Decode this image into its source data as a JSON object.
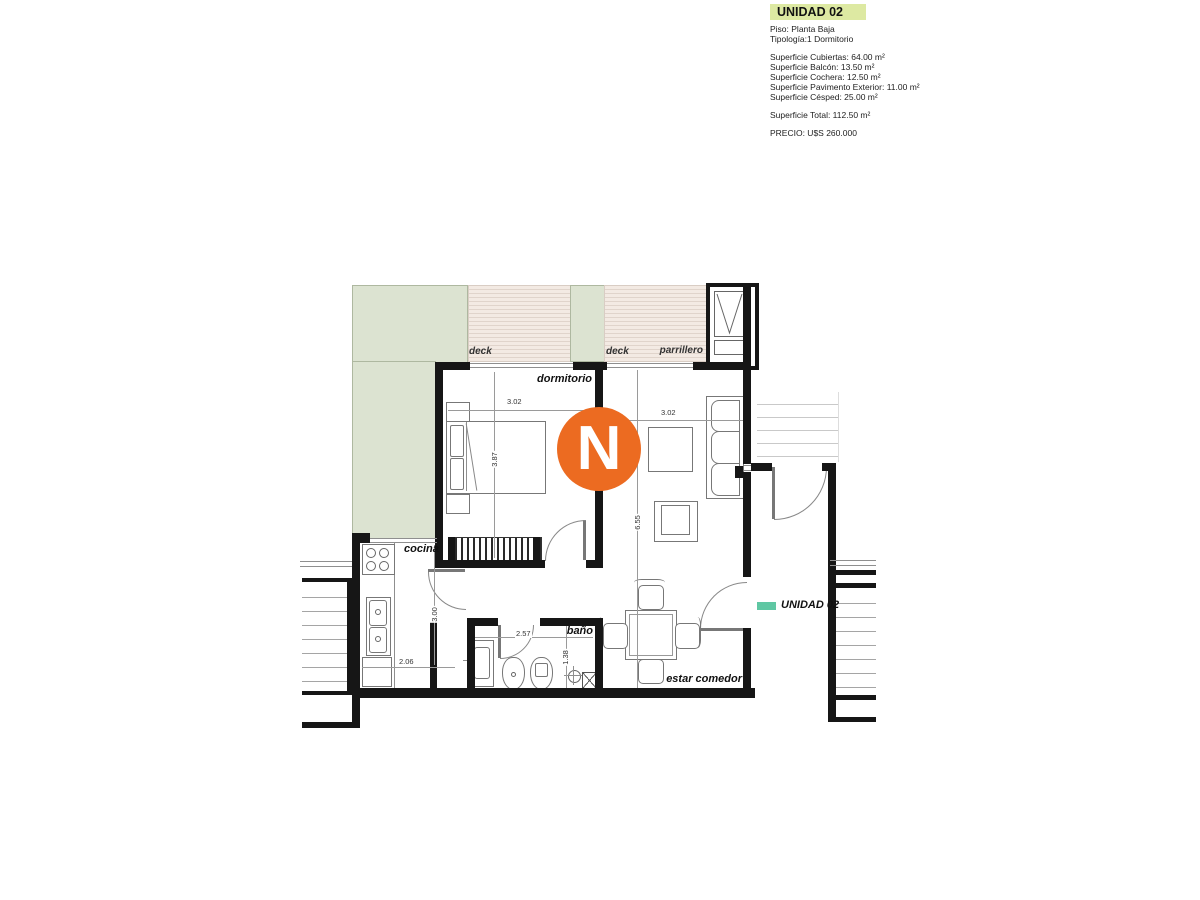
{
  "info_panel": {
    "title": "UNIDAD 02",
    "piso": "Piso: Planta Baja",
    "tipologia": "Tipología:1 Dormitorio",
    "superficies": [
      "Superficie Cubiertas: 64.00 m²",
      "Superficie Balcón: 13.50 m²",
      "Superficie Cochera: 12.50 m²",
      "Superficie Pavimento Exterior: 11.00 m²",
      "Superficie Césped: 25.00 m²"
    ],
    "total": "Superficie Total: 112.50 m²",
    "precio": "PRECIO: U$S 260.000"
  },
  "plan": {
    "north_letter": "N",
    "entry_arrow_label": "UNIDAD 02",
    "labels": {
      "dormitorio": "dormitorio",
      "cocina": "cocina",
      "bano": "baño",
      "estar_comedor": "estar comedor",
      "deck_left": "deck",
      "deck_right": "deck",
      "parrillero": "parrillero"
    },
    "dims": {
      "dorm_width": "3.02",
      "dorm_depth": "3.87",
      "living_width": "3.02",
      "living_depth": "6.55",
      "cocina_depth": "3.00",
      "cocina_width": "2.06",
      "bano_width": "2.57",
      "bano_depth": "1.38"
    }
  },
  "colors": {
    "accent_orange": "#ec6b21",
    "accent_teal": "#5fc7a3",
    "title_highlight": "#dde9a2",
    "cesped_green": "#dce3d1",
    "deck_beige": "#f3eae3"
  }
}
